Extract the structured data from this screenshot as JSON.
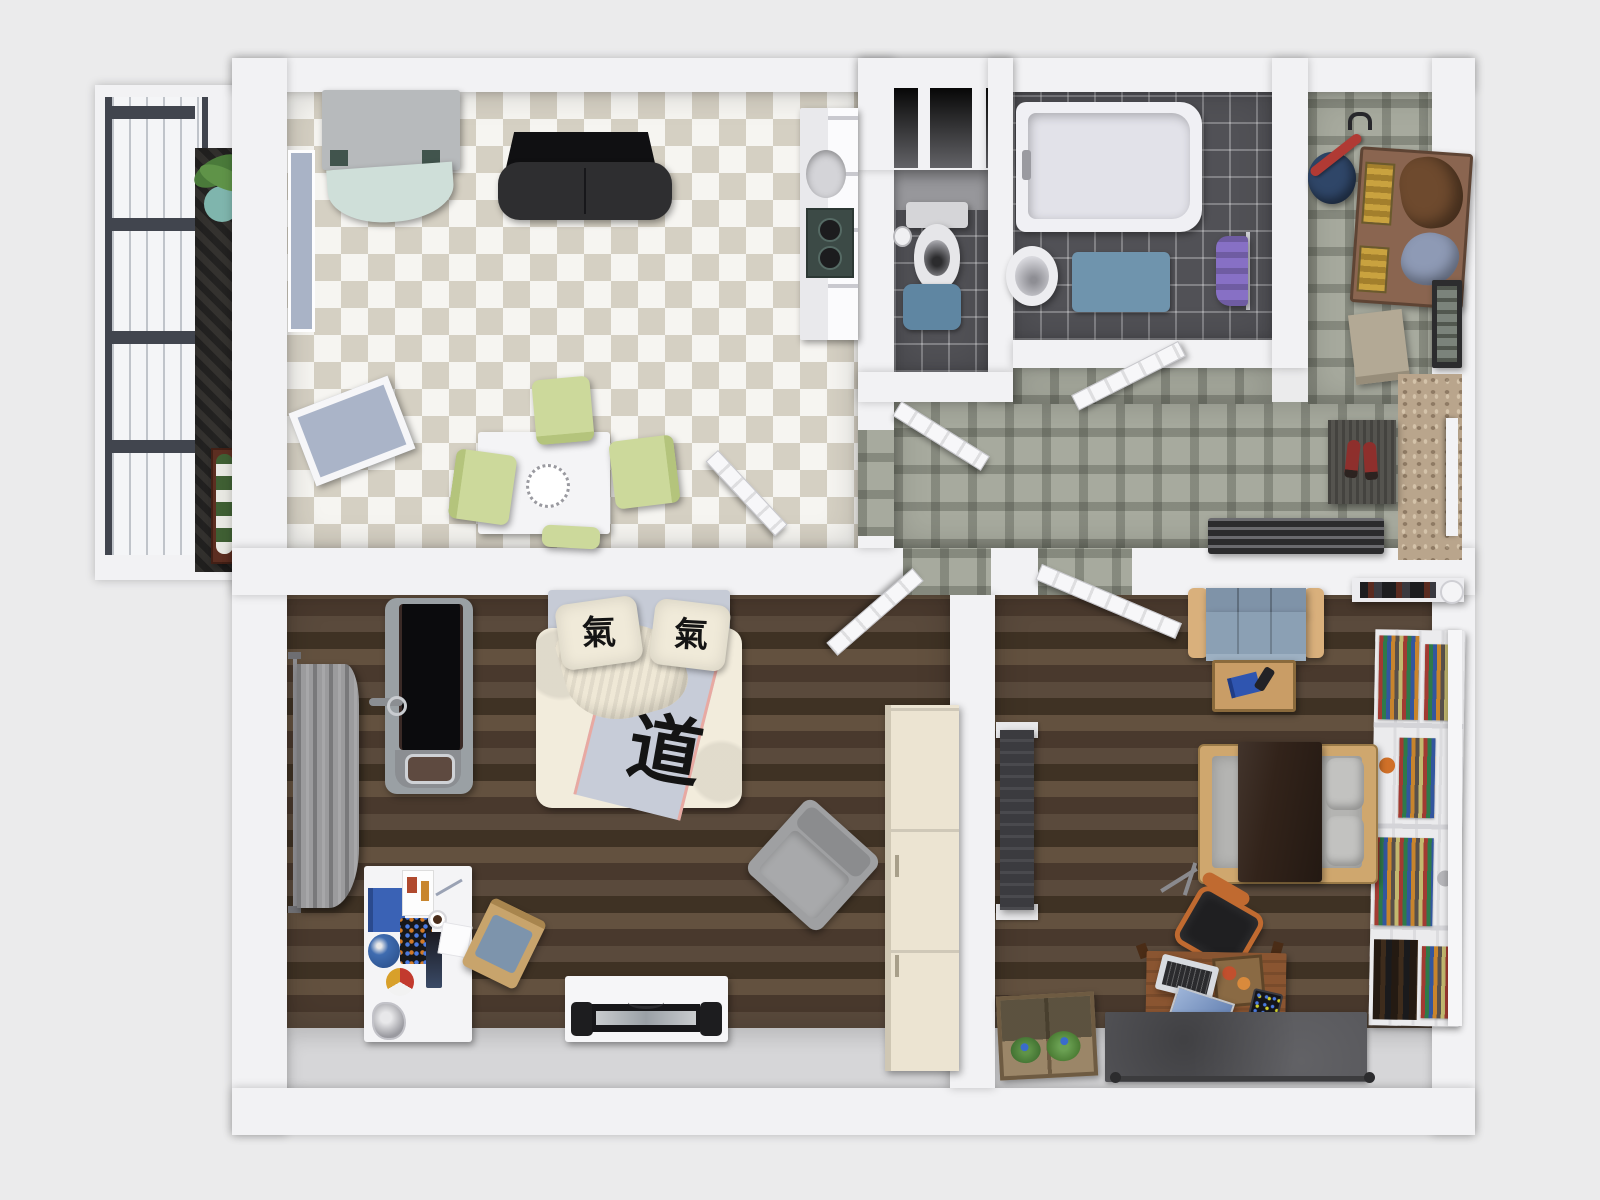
{
  "scene": {
    "type": "apartment-floor-plan-top-view",
    "text": {
      "pillow_left_glyph": "氣",
      "pillow_right_glyph": "氣",
      "duvet_glyph": "道"
    },
    "rooms": [
      {
        "id": "balcony",
        "label": "balcony"
      },
      {
        "id": "kitchen",
        "label": "kitchen-dining"
      },
      {
        "id": "wc",
        "label": "toilet-room"
      },
      {
        "id": "bathroom",
        "label": "bathroom"
      },
      {
        "id": "hallway",
        "label": "entry-hallway"
      },
      {
        "id": "bedroom",
        "label": "bedroom"
      },
      {
        "id": "living-room",
        "label": "living-room"
      }
    ]
  },
  "palette": {
    "background": "#ebebec",
    "wall": "#f2f2f4",
    "corridor_floor": "#a7aa9e",
    "dark_tile": "#515156",
    "wood_floor": "#4e4034",
    "light_floor": "#d6d6d8",
    "fridge_front": "#cfdfd9",
    "chair_green": "#ccd99b",
    "table_white": "#f4f4f6",
    "wc_mat": "#5f86a2",
    "bath_mat": "#6f94ad",
    "towel_purple": "#8770c5",
    "tub_white": "#f0f0f4",
    "duvet_cream": "#f2ecdc",
    "sheet_gray": "#c6cbd6",
    "duvet_band": "#c7ccd8",
    "armchair_gray": "#9fa0a2",
    "curtain_gray": "#9b9b9d",
    "sofa_blue": "#8ba0b4",
    "sofa_wood": "#d9b07c",
    "futon_frame": "#cfa76e",
    "futon_blanket": "#32231a",
    "futon_mattress": "#b4b4b2",
    "bookshelf_white": "#ebebed",
    "rug_gray": "#56565a",
    "desk_wood": "#8a5531",
    "office_chair_orange": "#c06a30",
    "wardrobe_cream": "#ece4d2",
    "tv_bench_white": "#f6f6f8",
    "radiator_dark": "#3b3b3f",
    "bench_wood": "#8a6550",
    "umbrella_red": "#b03a34",
    "umbrella_stand_blue": "#2f4668",
    "treadmill_belt": "#0b0b0d",
    "kitchen_unit_black": "#2e2e30"
  }
}
